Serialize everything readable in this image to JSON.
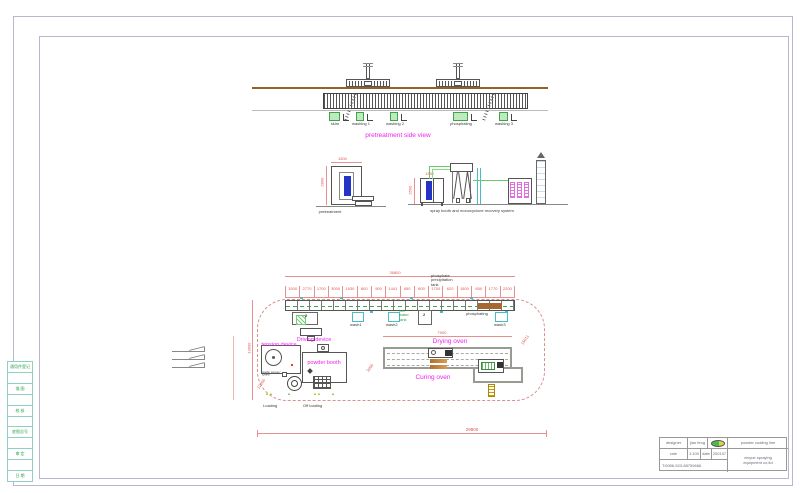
{
  "side_view": {
    "title": "pretreatment side view",
    "tank_labels": [
      "skim",
      "washing 1",
      "washing 2",
      "phosphating",
      "washing 3"
    ]
  },
  "elevation": {
    "pretreatment_label": "pretreatment",
    "spray_label": "spray booth and monocyclone recovery system",
    "dims": {
      "frame_top": "1500",
      "frame_side": "2800",
      "booth_side": "2500",
      "booth_top": "1350"
    }
  },
  "plan": {
    "overall_top_dim": "26800",
    "overall_bottom_dim": "29800",
    "left_vertical_dim": "13900",
    "oven_top_dim": "7000",
    "diag_dims": {
      "right": "15011",
      "left": "12000",
      "mid": "3000"
    },
    "segment_dims": [
      "1500",
      "2770",
      "1700",
      "3000",
      "1930",
      "800",
      "900",
      "1441",
      "650",
      "800",
      "1700",
      "620",
      "1500",
      "650",
      "1770",
      "2200"
    ],
    "note_lines": [
      "phosphate",
      "precipitation",
      "tank"
    ],
    "labels": {
      "driving_device": "Driving device",
      "tension_device": "tension device",
      "powder_booth": "powder booth",
      "powder_recovery": "powder recovery system",
      "drying_oven": "Drying oven",
      "curing_oven": "Curing oven",
      "loading": "Loading",
      "off_loading": "Off loading",
      "wash1": "wash1",
      "wash2": "wash2",
      "wash3": "wash3",
      "phosphating": "phosphating",
      "hot_water_tank_lines": [
        "hot",
        "water",
        "tank"
      ],
      "pump_no": "2"
    }
  },
  "title_block": {
    "designer_label": "designer",
    "designer_value": "jiao feng",
    "scale_label": "rate",
    "scale_value": "1:100",
    "date_label": "date",
    "date_value": "200107",
    "phone": "T:0086-523-88759666",
    "project": "powder coating line",
    "company_lines": [
      "xinyue spraying",
      "equipment co,ltd"
    ]
  },
  "revision_strip": {
    "rows": [
      "通用件登记",
      "",
      "描 图",
      "",
      "校 核",
      "",
      "底图总号",
      "",
      "审 定",
      "",
      "日 期"
    ]
  }
}
